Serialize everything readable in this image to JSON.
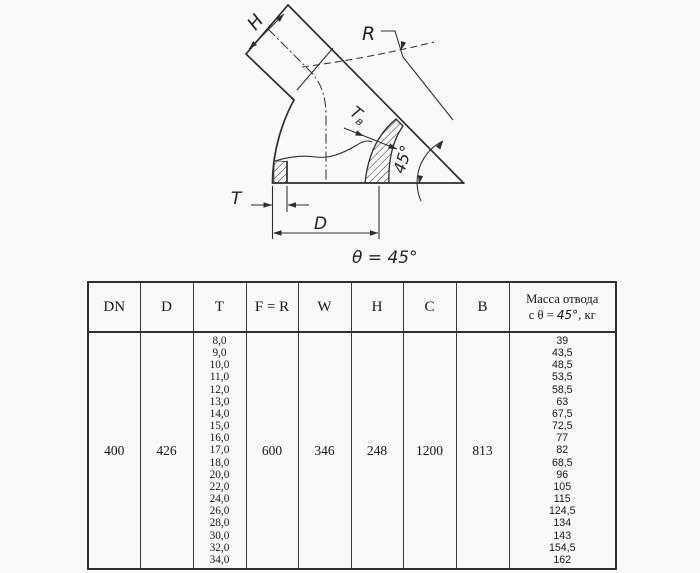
{
  "drawing": {
    "labels": {
      "h": "H",
      "r": "R",
      "tv_main": "T",
      "tv_sub": "в",
      "angle_45": "45°",
      "t": "T",
      "d": "D",
      "theta_eq": "θ = 45°"
    }
  },
  "table": {
    "headers": [
      "DN",
      "D",
      "T",
      "F = R",
      "W",
      "H",
      "C",
      "B"
    ],
    "mass_header_line1": "Масса отвода",
    "mass_header_line2_prefix": "с θ = ",
    "mass_header_line2_angle": "45°",
    "mass_header_line2_suffix": ", кг",
    "row": {
      "dn": "400",
      "d": "426",
      "t_values": [
        "8,0",
        "9,0",
        "10,0",
        "11,0",
        "12,0",
        "13,0",
        "14,0",
        "15,0",
        "16,0",
        "17,0",
        "18,0",
        "20,0",
        "22,0",
        "24,0",
        "26,0",
        "28,0",
        "30,0",
        "32,0",
        "34,0"
      ],
      "f_r": "600",
      "w": "346",
      "h": "248",
      "c": "1200",
      "b": "813",
      "mass_values": [
        "39",
        "43,5",
        "48,5",
        "53,5",
        "58,5",
        "63",
        "67,5",
        "72,5",
        "77",
        "82",
        "68,5",
        "96",
        "105",
        "115",
        "124,5",
        "134",
        "143",
        "154,5",
        "162"
      ]
    }
  },
  "colors": {
    "line": "#2e2e2e",
    "paper": "#f9f9f7"
  }
}
